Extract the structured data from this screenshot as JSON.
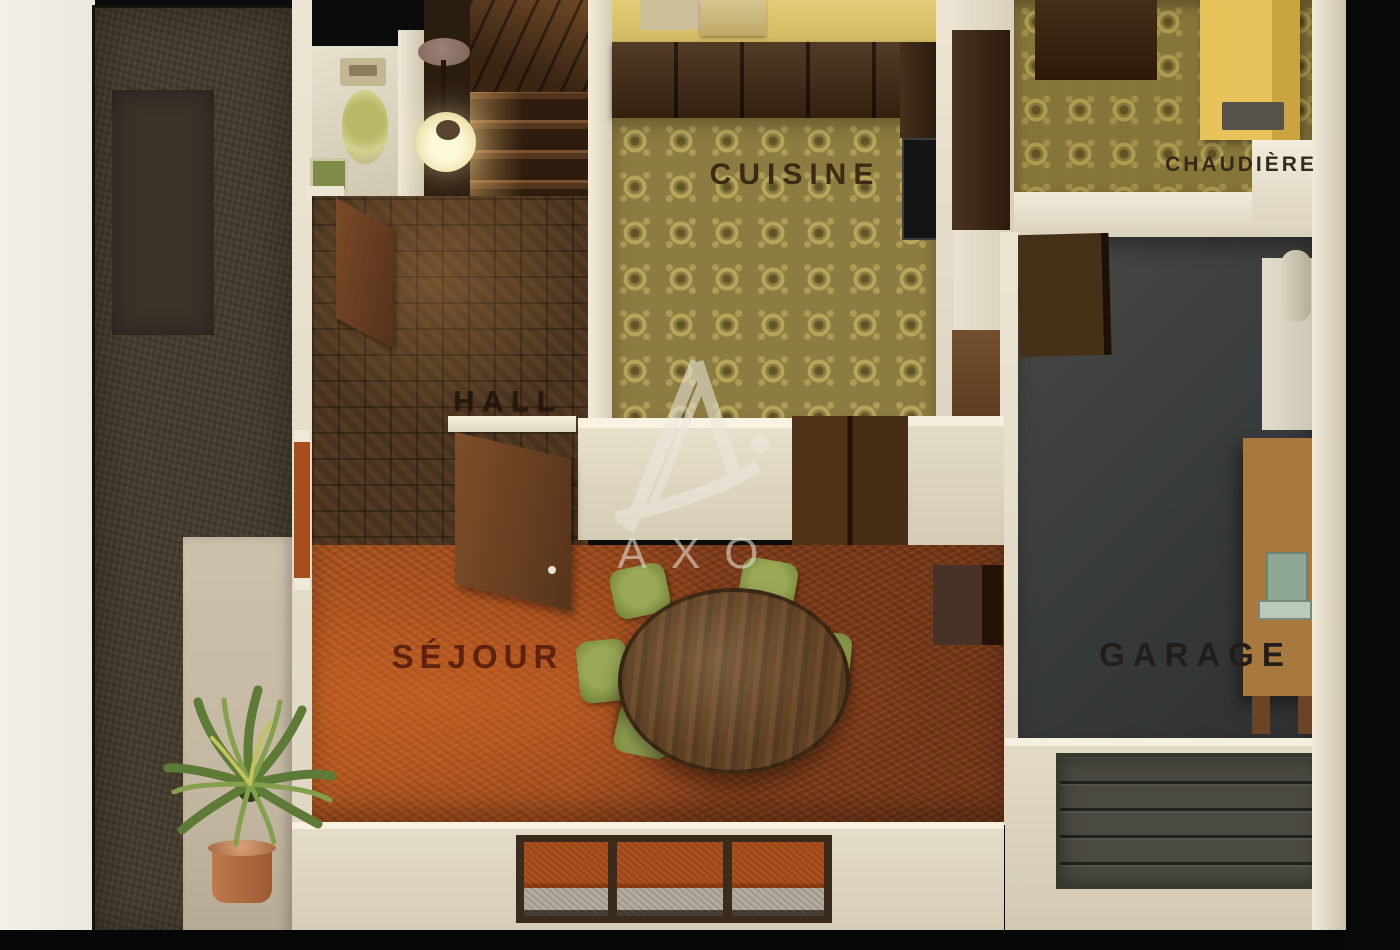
{
  "watermark": {
    "letter": "A",
    "text": "AXO"
  },
  "rooms": {
    "cuisine": {
      "label": "CUISINE"
    },
    "chaudiere": {
      "label": "CHAUDIÈRE"
    },
    "hall": {
      "label": "HALL"
    },
    "sejour": {
      "label": "SÉJOUR"
    },
    "garage": {
      "label": "GARAGE"
    }
  },
  "palette": {
    "background": "#0a0a0a",
    "wall_cream": "#e8e1cf",
    "kitchen_wall_yellow": "#d8c06a",
    "kitchen_floor_olive": "#8d7c41",
    "hall_parquet_brown": "#49331f",
    "sejour_carpet_orange": "#ad5420",
    "dining_carpet_rust": "#7e3c1b",
    "garage_floor_gray": "#3c3e39",
    "garage_door_gray": "#4b4a42",
    "garden_soil_brown": "#463d2f",
    "terrace_beige": "#c9bda7",
    "boiler_yellow": "#e8c35c",
    "chair_green": "#8b9b4d",
    "table_wood_brown": "#5a3f24",
    "plant_green": "#6b8a3f",
    "pot_terracotta": "#b06a42"
  }
}
